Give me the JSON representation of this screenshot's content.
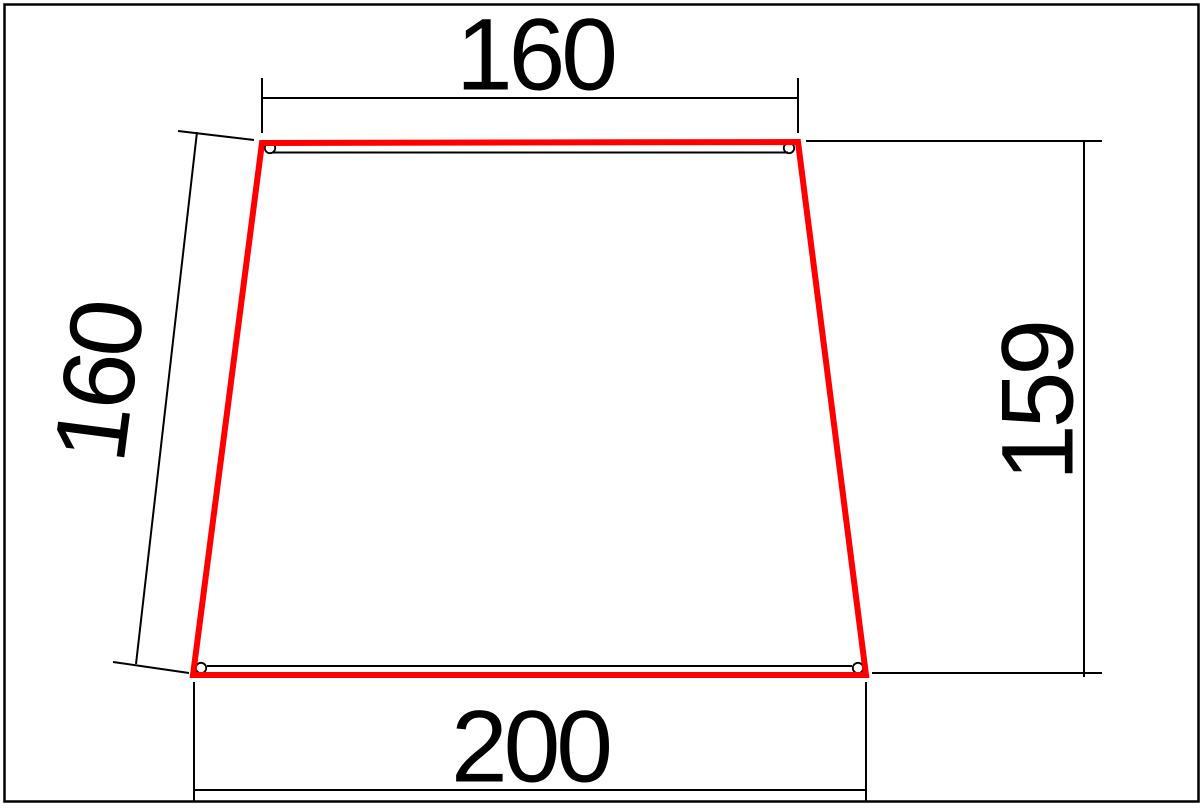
{
  "drawing": {
    "title": "trapezoid-panel-dimension-drawing",
    "shape": "trapezoid",
    "colors": {
      "outline": "#ff0000",
      "lines": "#000000",
      "background": "#ffffff"
    },
    "dimensions": {
      "top_width": {
        "label": "160",
        "value": 160,
        "orientation": "horizontal"
      },
      "left_slant": {
        "label": "160",
        "value": 160,
        "orientation": "aligned-with-left-side"
      },
      "right_height": {
        "label": "159",
        "value": 159,
        "orientation": "vertical"
      },
      "bottom_width": {
        "label": "200",
        "value": 200,
        "orientation": "horizontal"
      }
    }
  }
}
